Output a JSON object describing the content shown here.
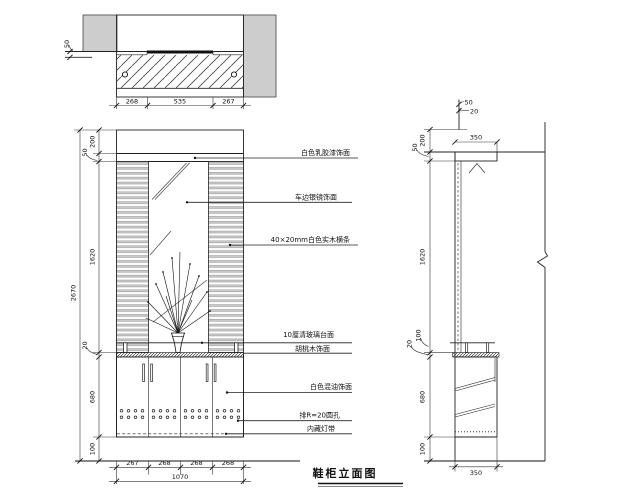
{
  "title": {
    "text": "鞋柜立面图"
  },
  "plan": {
    "dim_50": "50",
    "dim_left": "268",
    "dim_mid": "535",
    "dim_right": "267"
  },
  "front": {
    "left": {
      "zone_top": "200",
      "zone_trim": "50",
      "zone_mirror": "1620",
      "zone_counter": "20",
      "zone_cabinet": "680",
      "zone_base": "100",
      "overall": "2670"
    },
    "bottom": {
      "door1": "267",
      "door2": "268",
      "door3": "268",
      "door4": "268",
      "total": "1070"
    }
  },
  "side": {
    "top_offset": "50",
    "top_thickness": "20",
    "zone_top": "200",
    "depth_top": "350",
    "board": "50",
    "zone_mirror": "1620",
    "rail": "100",
    "counter": "20",
    "cabinet": "680",
    "base": "100",
    "depth_bottom": "350"
  },
  "annotations": {
    "a1": "白色乳胶漆饰面",
    "a2": "车边银镜饰面",
    "a3": "40×20mm白色实木横条",
    "a4": "10厘清玻璃台面",
    "a5": "胡桃木饰面",
    "a6": "白色混油饰面",
    "a7": "排R=20圆孔",
    "a8": "内藏灯带"
  }
}
